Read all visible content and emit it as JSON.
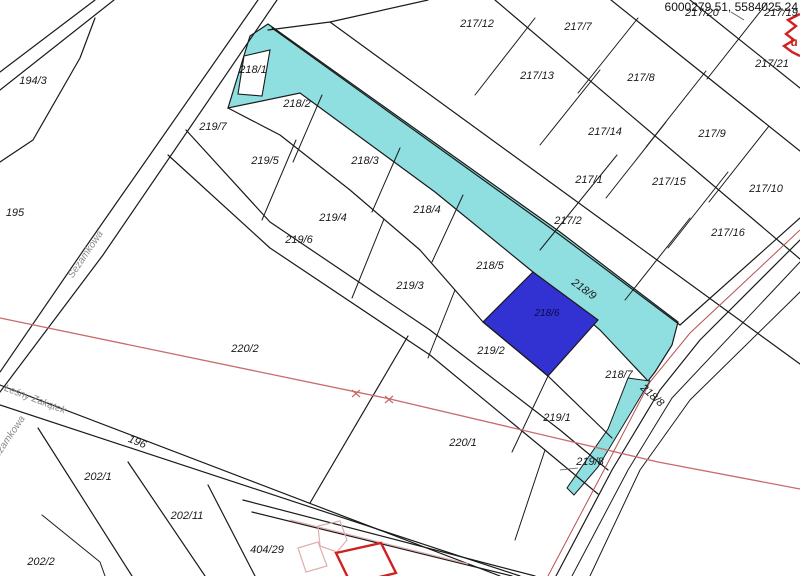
{
  "map": {
    "title": "cadastral-parcel-map",
    "background": "#FFFFFF",
    "line_color": "#1A1A1A",
    "highlight_color": "#8FDEE0",
    "selected_color": "#3232D2",
    "red_line_color": "#C96A6A",
    "road_centerline_color": "#B85050",
    "building_color": "#D02020",
    "street_color": "#8A8A8A",
    "coordinates_display": "6000279.51, 5584025.24",
    "selected_parcel": "218/6",
    "highlighted_parcels": [
      "218/9",
      "218/8"
    ],
    "parcel_labels": [
      {
        "label": "194/3",
        "x": 33,
        "y": 84,
        "rot": 0
      },
      {
        "label": "195",
        "x": 15,
        "y": 216,
        "rot": 0
      },
      {
        "label": "196",
        "x": 136,
        "y": 445,
        "rot": 22
      },
      {
        "label": "202/1",
        "x": 98,
        "y": 480,
        "rot": 0
      },
      {
        "label": "202/11",
        "x": 187,
        "y": 519,
        "rot": 0
      },
      {
        "label": "202/2",
        "x": 41,
        "y": 565,
        "rot": 0
      },
      {
        "label": "404/29",
        "x": 267,
        "y": 553,
        "rot": 0
      },
      {
        "label": "218/1",
        "x": 253,
        "y": 73,
        "rot": 0
      },
      {
        "label": "219/7",
        "x": 213,
        "y": 130,
        "rot": 0
      },
      {
        "label": "218/2",
        "x": 297,
        "y": 107,
        "rot": 0
      },
      {
        "label": "218/3",
        "x": 365,
        "y": 164,
        "rot": 0
      },
      {
        "label": "218/4",
        "x": 427,
        "y": 213,
        "rot": 0
      },
      {
        "label": "218/5",
        "x": 490,
        "y": 269,
        "rot": 0
      },
      {
        "label": "218/6",
        "x": 547,
        "y": 316,
        "rot": 0,
        "selected": true
      },
      {
        "label": "218/7",
        "x": 619,
        "y": 378,
        "rot": 0
      },
      {
        "label": "218/9",
        "x": 582,
        "y": 292,
        "rot": 36
      },
      {
        "label": "218/8",
        "x": 650,
        "y": 398,
        "rot": 42
      },
      {
        "label": "219/8",
        "x": 590,
        "y": 465,
        "rot": 0
      },
      {
        "label": "219/5",
        "x": 265,
        "y": 164,
        "rot": 0
      },
      {
        "label": "219/4",
        "x": 333,
        "y": 221,
        "rot": 0
      },
      {
        "label": "219/6",
        "x": 299,
        "y": 243,
        "rot": 0
      },
      {
        "label": "219/3",
        "x": 410,
        "y": 289,
        "rot": 0
      },
      {
        "label": "219/2",
        "x": 491,
        "y": 354,
        "rot": 0
      },
      {
        "label": "219/1",
        "x": 557,
        "y": 421,
        "rot": 0
      },
      {
        "label": "220/2",
        "x": 245,
        "y": 352,
        "rot": 0
      },
      {
        "label": "220/1",
        "x": 463,
        "y": 446,
        "rot": 0
      },
      {
        "label": "217/12",
        "x": 477,
        "y": 27,
        "rot": 0
      },
      {
        "label": "217/7",
        "x": 578,
        "y": 30,
        "rot": 0
      },
      {
        "label": "217/20",
        "x": 702,
        "y": 16,
        "rot": 0
      },
      {
        "label": "217/19",
        "x": 781,
        "y": 16,
        "rot": 0
      },
      {
        "label": "217/13",
        "x": 537,
        "y": 79,
        "rot": 0
      },
      {
        "label": "217/8",
        "x": 641,
        "y": 81,
        "rot": 0
      },
      {
        "label": "217/21",
        "x": 772,
        "y": 67,
        "rot": 0
      },
      {
        "label": "217/14",
        "x": 605,
        "y": 135,
        "rot": 0
      },
      {
        "label": "217/9",
        "x": 712,
        "y": 137,
        "rot": 0
      },
      {
        "label": "217/1",
        "x": 589,
        "y": 183,
        "rot": 0
      },
      {
        "label": "217/15",
        "x": 669,
        "y": 185,
        "rot": 0
      },
      {
        "label": "217/10",
        "x": 766,
        "y": 192,
        "rot": 0
      },
      {
        "label": "217/2",
        "x": 568,
        "y": 224,
        "rot": 0
      },
      {
        "label": "217/16",
        "x": 728,
        "y": 236,
        "rot": 0
      }
    ],
    "street_labels": [
      {
        "name": "Sezamkowa",
        "x": 88,
        "y": 256,
        "rot": -56
      },
      {
        "name": "Leśny Zakątek",
        "x": 34,
        "y": 402,
        "rot": 21
      },
      {
        "name": "Sezamkowa",
        "x": 10,
        "y": 441,
        "rot": -56
      }
    ],
    "annotation_labels": [
      {
        "text": "u",
        "x": 794,
        "y": 46
      }
    ]
  }
}
